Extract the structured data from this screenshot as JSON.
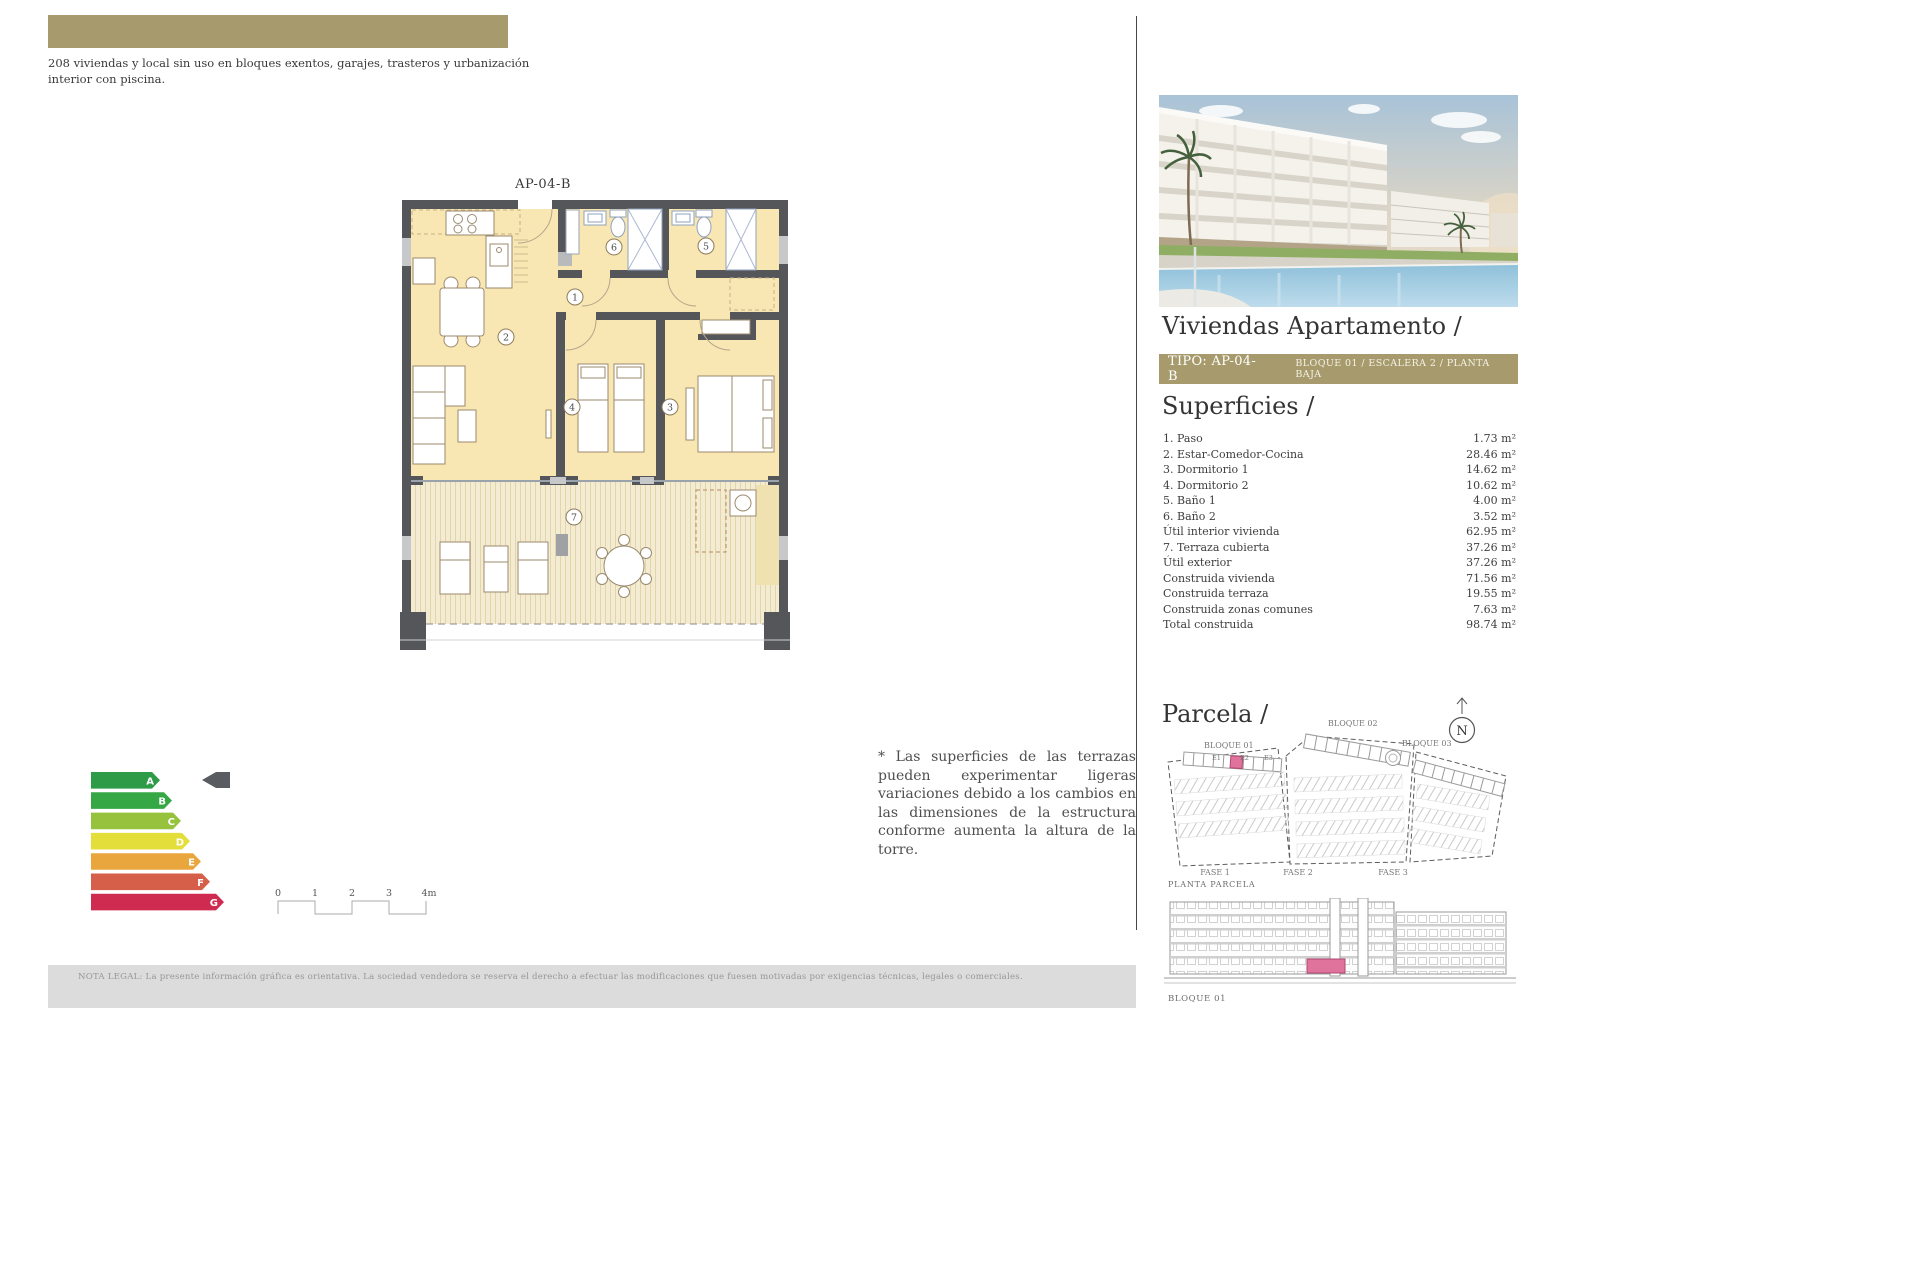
{
  "intro": "208 viviendas y local sin uso en bloques exentos, garajes, trasteros y urbanización interior con piscina.",
  "floor_plan": {
    "title": "AP-04-B",
    "room_numbers": [
      "1",
      "2",
      "3",
      "4",
      "5",
      "6",
      "7"
    ]
  },
  "energy_label": {
    "grades": [
      "A",
      "B",
      "C",
      "D",
      "E",
      "F",
      "G"
    ],
    "colors": [
      "#2d9b48",
      "#35a845",
      "#96c23d",
      "#e4de3b",
      "#e8a63c",
      "#d55f48",
      "#cf2b50"
    ],
    "pointer_color": "#595d62"
  },
  "scale_bar": {
    "ticks": [
      "0",
      "1",
      "2",
      "3",
      "4m"
    ]
  },
  "terrace_note": "* Las superficies de las terrazas pueden experimentar ligeras variaciones debido a los cambios en las dimensiones de la estructura conforme aumenta la altura de la torre.",
  "panel": {
    "title": "Viviendas Apartamento /",
    "tipo": {
      "label": "TIPO: AP-04-B",
      "location": "BLOQUE 01 / ESCALERA 2 / PLANTA BAJA",
      "bg_color": "#a79b6d"
    },
    "superficies": {
      "heading": "Superficies /",
      "rows": [
        {
          "label": "1. Paso",
          "value": "1.73 m²"
        },
        {
          "label": "2. Estar-Comedor-Cocina",
          "value": "28.46 m²"
        },
        {
          "label": "3. Dormitorio 1",
          "value": "14.62 m²"
        },
        {
          "label": "4. Dormitorio 2",
          "value": "10.62 m²"
        },
        {
          "label": "5. Baño 1",
          "value": "4.00 m²"
        },
        {
          "label": "6. Baño 2",
          "value": "3.52 m²"
        },
        {
          "label": "Útil interior vivienda",
          "value": "62.95 m²"
        },
        {
          "label": "7. Terraza cubierta",
          "value": "37.26 m²"
        },
        {
          "label": "Útil exterior",
          "value": "37.26 m²"
        },
        {
          "label": "Construida vivienda",
          "value": "71.56 m²"
        },
        {
          "label": "Construida terraza",
          "value": "19.55 m²"
        },
        {
          "label": "Construida zonas comunes",
          "value": "7.63 m²"
        },
        {
          "label": "Total construida",
          "value": "98.74 m²"
        }
      ]
    },
    "parcela": {
      "heading": "Parcela /",
      "compass": "N",
      "blocks": [
        "BLOQUE 01",
        "BLOQUE 02",
        "BLOQUE 03"
      ],
      "escaleras": [
        "E1",
        "E2",
        "E3"
      ],
      "fases": [
        "FASE 1",
        "FASE 2",
        "FASE 3"
      ],
      "caption": "PLANTA PARCELA",
      "highlight_color": "#e0739c"
    },
    "elevation": {
      "caption": "BLOQUE 01",
      "highlight_color": "#e0739c"
    }
  },
  "legal": "NOTA LEGAL: La presente información gráfica es orientativa. La sociedad vendedora se reserva el derecho a efectuar las modificaciones que fuesen motivadas por exigencias técnicas, legales o comerciales."
}
